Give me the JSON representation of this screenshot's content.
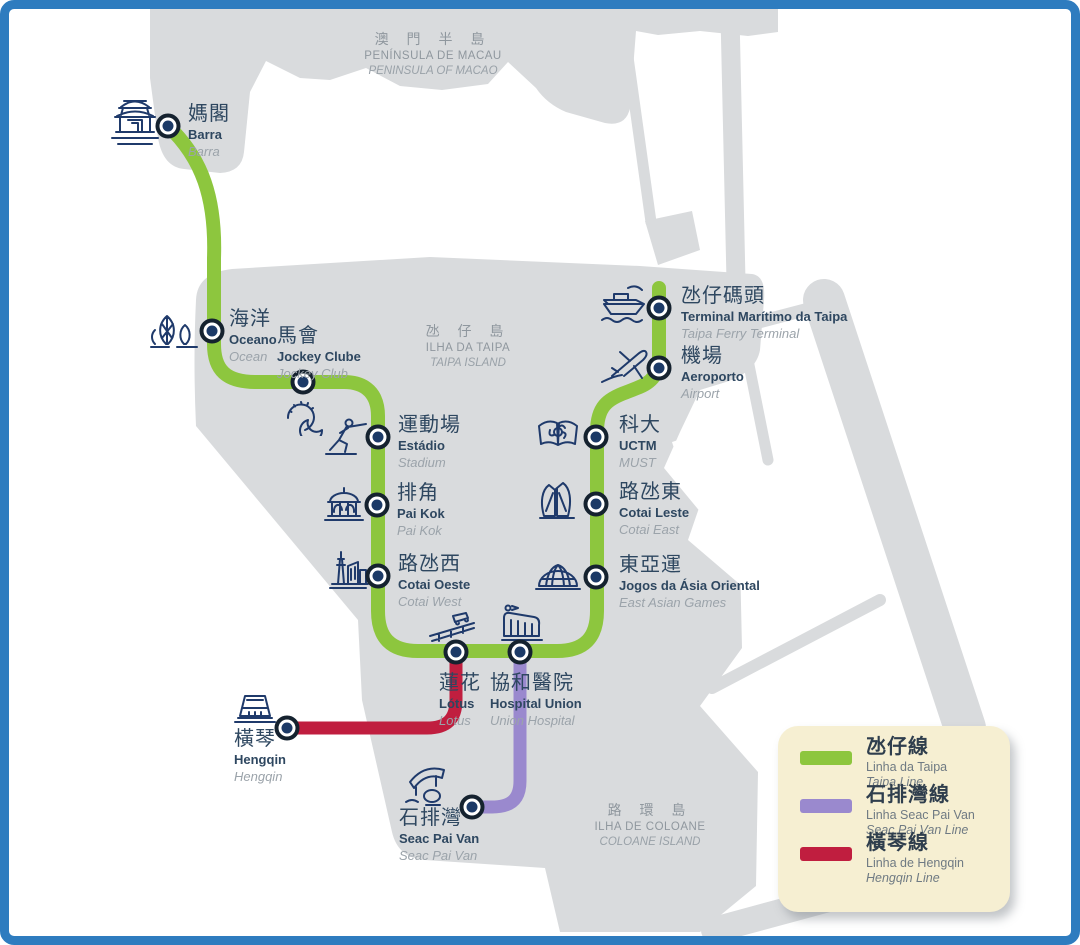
{
  "colors": {
    "frame": "#2E7CBF",
    "land": "#D9DBDD",
    "sea": "#FFFFFF",
    "taipa_line_green": "#8DC63E",
    "seac_pai_van_line_purple": "#9A89CE",
    "hengqin_line_red": "#C01E3F",
    "marker_ring": "#15222F",
    "marker_dot": "#1C3A67",
    "icon_stroke": "#1F3A6B",
    "label_dark": "#2E4760",
    "label_muted": "#9BA3AA",
    "region_label": "#8F979E",
    "legend_bg": "#F6EFD2"
  },
  "regions": [
    {
      "zh": "澳 門 半 島",
      "pt": "PENÍNSULA DE MACAU",
      "en": "PENINSULA OF MACAO"
    },
    {
      "zh": "氹 仔 島",
      "pt": "ILHA DA TAIPA",
      "en": "TAIPA ISLAND"
    },
    {
      "zh": "路 環 島",
      "pt": "ILHA DE COLOANE",
      "en": "COLOANE ISLAND"
    }
  ],
  "stations": [
    {
      "zh": "媽閣",
      "pt": "Barra",
      "en": "Barra",
      "icon": "temple"
    },
    {
      "zh": "海洋",
      "pt": "Oceano",
      "en": "Ocean",
      "icon": "ocean-towers"
    },
    {
      "zh": "馬會",
      "pt": "Jockey Clube",
      "en": "Jockey Club",
      "icon": "horseshoe"
    },
    {
      "zh": "運動場",
      "pt": "Estádio",
      "en": "Stadium",
      "icon": "fencer"
    },
    {
      "zh": "排角",
      "pt": "Pai Kok",
      "en": "Pai Kok",
      "icon": "pavilion"
    },
    {
      "zh": "路氹西",
      "pt": "Cotai Oeste",
      "en": "Cotai West",
      "icon": "tower-buildings"
    },
    {
      "zh": "蓮花",
      "pt": "Lótus",
      "en": "Lotus",
      "icon": "bridge"
    },
    {
      "zh": "協和醫院",
      "pt": "Hospital Union",
      "en": "Union Hospital",
      "icon": "hospital"
    },
    {
      "zh": "東亞運",
      "pt": "Jogos da Ásia Oriental",
      "en": "East Asian Games",
      "icon": "dome"
    },
    {
      "zh": "路氹東",
      "pt": "Cotai Leste",
      "en": "Cotai East",
      "icon": "book-building"
    },
    {
      "zh": "科大",
      "pt": "UCTM",
      "en": "MUST",
      "icon": "open-book"
    },
    {
      "zh": "機場",
      "pt": "Aeroporto",
      "en": "Airport",
      "icon": "airplane"
    },
    {
      "zh": "氹仔碼頭",
      "pt": "Terminal Marítimo da Taipa",
      "en": "Taipa Ferry Terminal",
      "icon": "ferry"
    },
    {
      "zh": "橫琴",
      "pt": "Hengqin",
      "en": "Hengqin",
      "icon": "border-building"
    },
    {
      "zh": "石排灣",
      "pt": "Seac Pai Van",
      "en": "Seac Pai Van",
      "icon": "panda-pavilion"
    }
  ],
  "legend": {
    "items": [
      {
        "zh": "氹仔線",
        "pt": "Linha da Taipa",
        "en": "Taipa Line",
        "color": "#8DC63E"
      },
      {
        "zh": "石排灣線",
        "pt": "Linha Seac Pai Van",
        "en": "Seac Pai Van Line",
        "color": "#9A89CE"
      },
      {
        "zh": "橫琴線",
        "pt": "Linha de Hengqin",
        "en": "Hengqin Line",
        "color": "#C01E3F"
      }
    ]
  }
}
